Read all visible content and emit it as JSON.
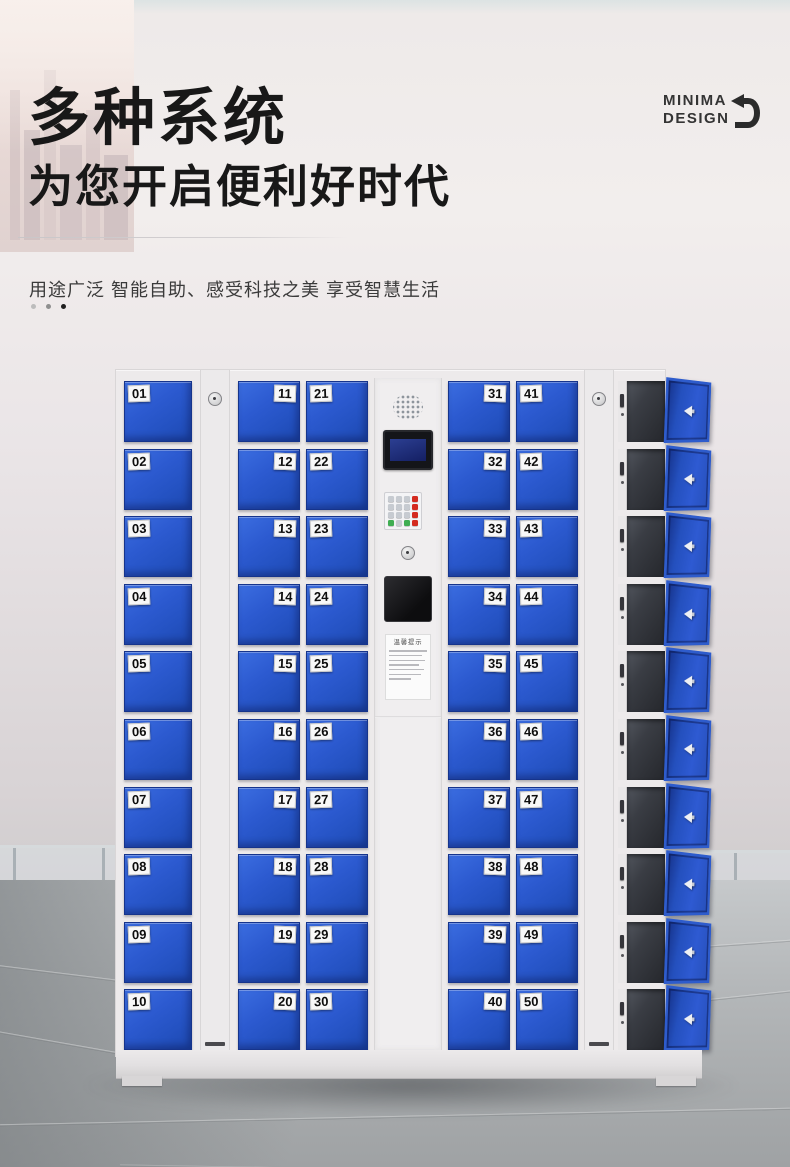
{
  "brand": {
    "line1": "MINIMA",
    "line2": "DESIGN",
    "icon": "return-arrow-icon"
  },
  "header": {
    "title_line1": "多种系统",
    "title_line2": "为您开启便利好时代",
    "subtitle": "用途广泛  智能自助、感受科技之美  享受智慧生活"
  },
  "locker": {
    "columns": [
      {
        "id": "col-01-10",
        "label_side": "left",
        "doors": [
          "01",
          "02",
          "03",
          "04",
          "05",
          "06",
          "07",
          "08",
          "09",
          "10"
        ]
      },
      {
        "id": "col-11-20",
        "label_side": "right",
        "doors": [
          "11",
          "12",
          "13",
          "14",
          "15",
          "16",
          "17",
          "18",
          "19",
          "20"
        ]
      },
      {
        "id": "col-21-30",
        "label_side": "left",
        "doors": [
          "21",
          "22",
          "23",
          "24",
          "25",
          "26",
          "27",
          "28",
          "29",
          "30"
        ]
      },
      {
        "id": "col-31-40",
        "label_side": "right",
        "doors": [
          "31",
          "32",
          "33",
          "34",
          "35",
          "36",
          "37",
          "38",
          "39",
          "40"
        ]
      },
      {
        "id": "col-41-50",
        "label_side": "left",
        "doors": [
          "41",
          "42",
          "43",
          "44",
          "45",
          "46",
          "47",
          "48",
          "49",
          "50"
        ]
      }
    ],
    "panel": {
      "notice_title": "温馨提示"
    },
    "open_column_rows": 10
  },
  "colors": {
    "door_blue": "#2b5ccd",
    "door_blue_dark": "#1d48b0",
    "frame_white": "#edeaeb",
    "red_key": "#d42b20",
    "green_key": "#3fae52",
    "title_text": "#181818"
  }
}
